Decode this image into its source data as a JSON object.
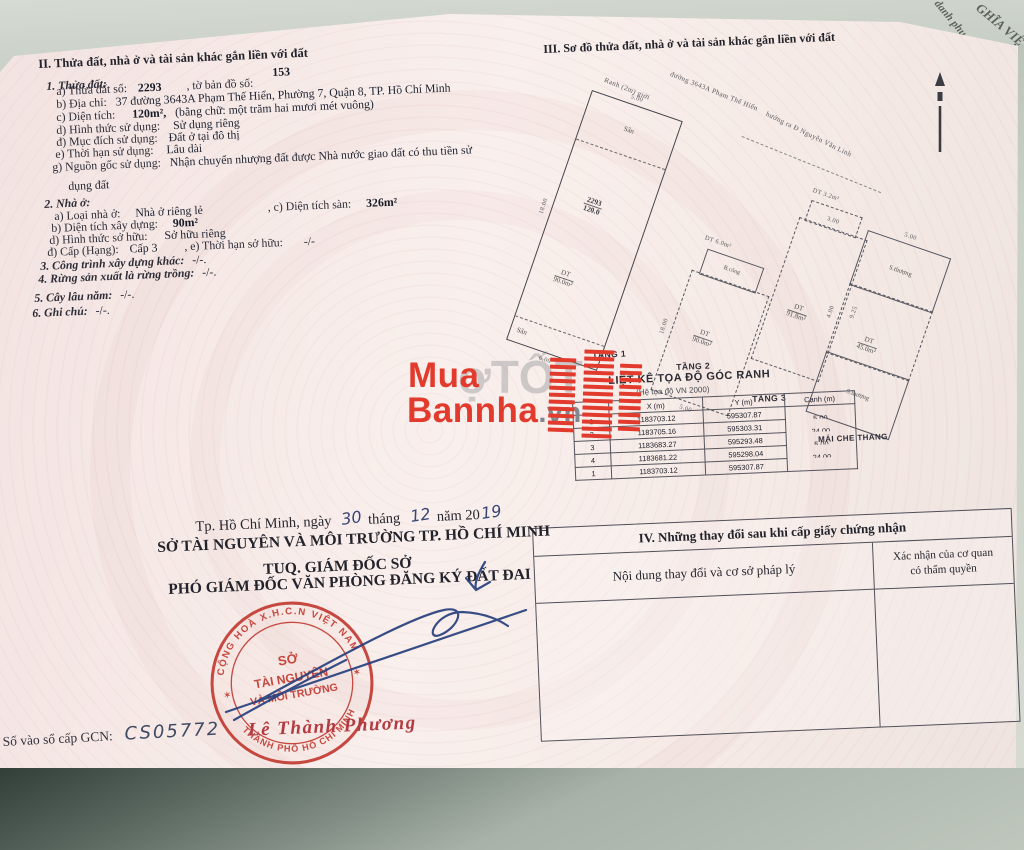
{
  "colors": {
    "brand_red": "#e23b2e",
    "seal_red": "#c23b32",
    "ink_blue": "#28407e",
    "paper_pink": "#f7ecea"
  },
  "env": {
    "behind1": "GHĨA VIỆ",
    "behind2": "danh phụ"
  },
  "watermark": {
    "line1": "Mua",
    "line2": "Bannha",
    "suffix": ".vn",
    "behind": "ợTỐT"
  },
  "section2": {
    "heading": "II. Thửa đất, nhà ở và tài sản khác gắn liền với đất",
    "land_title": "1. Thửa đất:",
    "a_label": "a) Thửa đất số:",
    "a_value": "2293",
    "a_label2": ", tờ bản đồ số:",
    "a_value2": "153",
    "b_label": "b) Địa chỉ:",
    "b_value": "37 đường 3643A Phạm Thế Hiển, Phường 7, Quận 8, TP. Hồ Chí Minh",
    "c_label": "c) Diện tích:",
    "c_value": "120m²,",
    "c_words": "(bằng chữ: một trăm hai mươi mét vuông)",
    "d_label": "d) Hình thức sử dụng:",
    "d_value": "Sử dụng riêng",
    "dd_label": "đ) Mục đích sử dụng:",
    "dd_value": "Đất ở tại đô thị",
    "e_label": "e) Thời hạn sử dụng:",
    "e_value": "Lâu dài",
    "g_label": "g) Nguồn gốc sử dụng:",
    "g_value": "Nhận chuyển nhượng đất được Nhà nước giao đất có thu tiền sử",
    "g_value2": "dụng đất",
    "house_title": "2. Nhà ở:",
    "ha_label": "a) Loại nhà ở:",
    "ha_value": "Nhà ở riêng lẻ",
    "ha_label2": ", c) Diện tích sàn:",
    "ha_value2": "326m²",
    "hb_label": "b) Diện tích xây dựng:",
    "hb_value": "90m²",
    "hd_label": "d) Hình thức sở hữu:",
    "hd_value": "Sở hữu riêng",
    "hdd_label": "đ) Cấp (Hạng):",
    "hdd_value": "Cấp 3",
    "hdd_label2": ", e) Thời hạn sở hữu:",
    "hdd_value2": "-/-",
    "item3": "3. Công trình xây dựng khác:",
    "item3_value": "-/-.",
    "item4": "4. Rừng sản xuất là rừng trồng:",
    "item4_value": "-/-.",
    "item5": "5. Cây lâu năm:",
    "item5_value": "-/-.",
    "item6": "6. Ghi chú:",
    "item6_value": "-/-."
  },
  "section3": {
    "heading": "III. Sơ đồ thửa đất, nhà ở và tài sản khác gắn liền với đất",
    "street": "đường 3643A Phạm Thế Hiển",
    "canal": "Ranh (2m) giới",
    "direction": "hướng ra Đ Nguyễn Văn Linh",
    "plans": [
      {
        "label": "TẦNG 1",
        "yard_top": "Sân",
        "yard_bottom": "Sân",
        "parcel_no": "2293",
        "parcel_area": "120.0",
        "dt": "DT",
        "area": "90.0m²",
        "dim_top": "5.00",
        "dim_side": "18.00",
        "dim_bottom": "6.00"
      },
      {
        "label": "TẦNG 2",
        "balcony": "B.công",
        "balcony_area": "DT 6.0m²",
        "dt": "DT",
        "area": "90.0m²",
        "dim_top": "5.00",
        "dim_side": "18.00"
      },
      {
        "label": "TẦNG 3",
        "balcony_area": "DT 3.2m²",
        "dt": "DT",
        "area": "91.8m²",
        "dim_top": "3.00",
        "dim_side": "9.25"
      },
      {
        "label": "MÁI CHE THANG",
        "terrace_top": "S.thượng",
        "terrace_bottom": "S.thượng",
        "dt": "DT",
        "area": "45.0m²",
        "dim_top": "5.00",
        "dim_mid": "4.00"
      }
    ],
    "coords": {
      "title": "LIỆT KÊ TỌA ĐỘ GÓC RANH",
      "subtitle": "(Hệ tọa độ VN 2000)",
      "col_x": "X (m)",
      "col_y": "Y (m)",
      "col_canh": "Cạnh (m)",
      "rows": [
        {
          "n": "1",
          "x": "1183703.12",
          "y": "595307.87",
          "canh": "5.00"
        },
        {
          "n": "2",
          "x": "1183705.16",
          "y": "595303.31",
          "canh": "24.00"
        },
        {
          "n": "3",
          "x": "1183683.27",
          "y": "595293.48",
          "canh": "5.00"
        },
        {
          "n": "4",
          "x": "1183681.22",
          "y": "595298.04",
          "canh": "24.00"
        },
        {
          "n": "1",
          "x": "1183703.12",
          "y": "595307.87",
          "canh": ""
        }
      ]
    }
  },
  "section4": {
    "title": "IV. Những thay đổi sau khi cấp giấy chứng nhận",
    "col1": "Nội dung thay đổi và cơ sở pháp lý",
    "col2_l1": "Xác nhận của cơ quan",
    "col2_l2": "có thẩm quyền"
  },
  "signing": {
    "place": "Tp. Hồ Chí Minh, ngày",
    "day": "30",
    "m_lbl": "tháng",
    "month": "12",
    "y_lbl": "năm 20",
    "year": "19",
    "org1": "SỞ TÀI NGUYÊN VÀ MÔI TRƯỜNG TP. HỒ CHÍ MINH",
    "org2": "TUQ. GIÁM ĐỐC SỞ",
    "org3": "PHÓ GIÁM ĐỐC VĂN PHÒNG ĐĂNG KÝ ĐẤT ĐAI",
    "signer": "Lê Thành Phương",
    "gcn_label": "Số vào sổ cấp GCN:",
    "gcn_value": "CS05772",
    "seal": {
      "top": "CỘNG HOÀ X.H.C.N VIỆT NAM",
      "c1": "SỞ",
      "c2": "TÀI NGUYÊN",
      "c3": "VÀ MÔI TRƯỜNG",
      "bottom": "THÀNH PHỐ HỒ CHÍ MINH",
      "star": "✶"
    }
  }
}
